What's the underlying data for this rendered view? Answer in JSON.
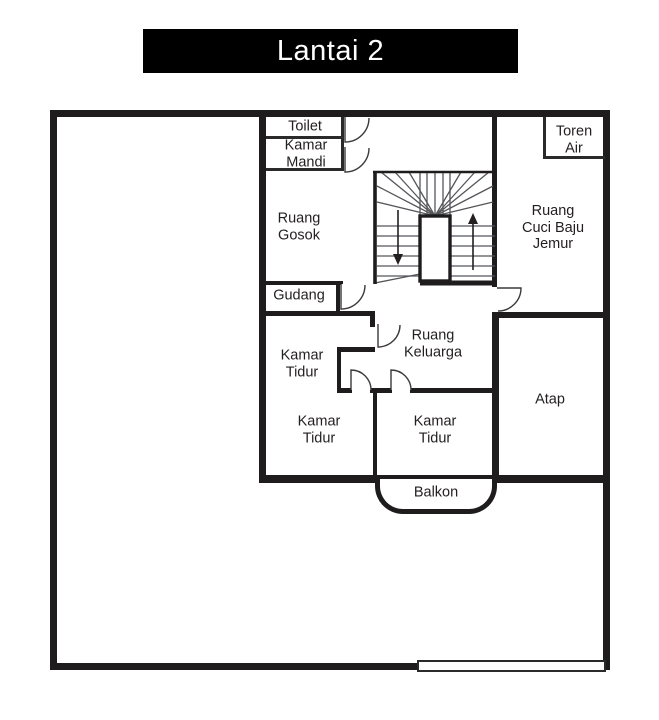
{
  "title_bar": {
    "label": "Lantai 2"
  },
  "rooms": {
    "toilet": "Toilet",
    "kamar_mandi": "Kamar\nMandi",
    "ruang_gosok": "Ruang\nGosok",
    "gudang": "Gudang",
    "kamar_tidur_middle": "Kamar\nTidur",
    "ruang_keluarga": "Ruang\nKeluarga",
    "kamar_tidur_bottom_left": "Kamar\nTidur",
    "kamar_tidur_bottom_right": "Kamar\nTidur",
    "balkon": "Balkon",
    "toren_air": "Toren\nAir",
    "ruang_cuci_baju_jemur": "Ruang\nCuci Baju\nJemur",
    "atap": "Atap"
  },
  "stairs": {
    "left_flight_direction": "down",
    "right_flight_direction": "up"
  },
  "colors": {
    "wall": "#1e1c1d",
    "thin_line": "#55565a",
    "title_bg": "#000000",
    "title_fg": "#ffffff",
    "background": "#ffffff"
  }
}
